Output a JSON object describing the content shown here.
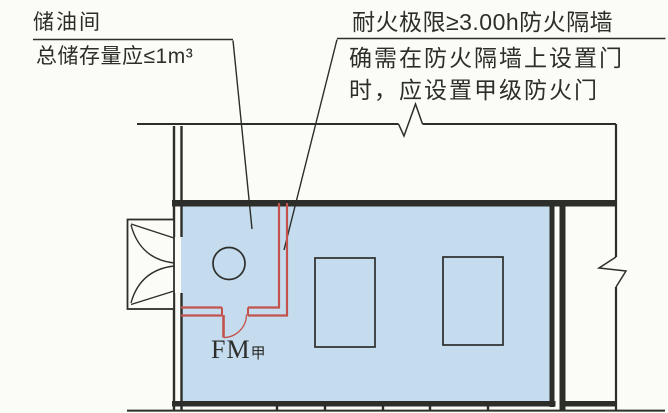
{
  "annotations": {
    "oil_room": {
      "line1": "储油间",
      "line2": "总储存量应≤1m³"
    },
    "firewall": {
      "line1": "耐火极限≥3.00h防火隔墙",
      "line2": "确需在防火隔墙上设置门",
      "line3": "时，应设置甲级防火门"
    },
    "fire_door": {
      "prefix": "FM",
      "grade": "甲"
    }
  },
  "colors": {
    "paper": "#fbfbf8",
    "line": "#2d2d2a",
    "room_fill": "#c4dcee",
    "firewall_red": "#c4524c"
  }
}
